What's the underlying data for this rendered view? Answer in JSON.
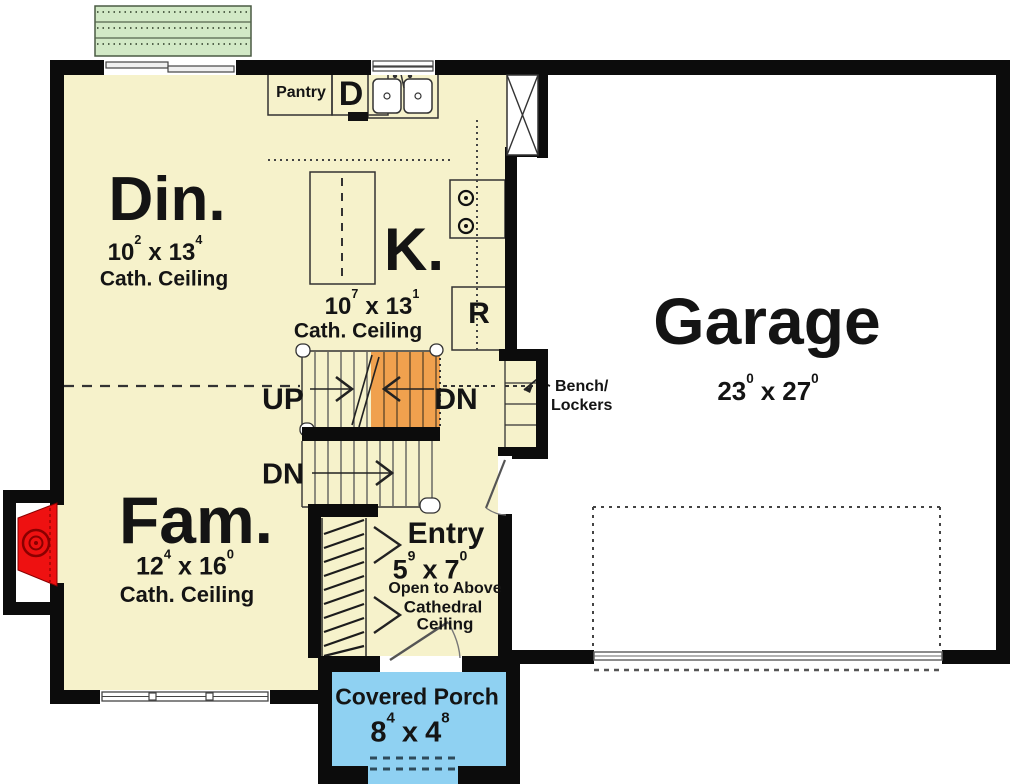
{
  "colors": {
    "floor": "#f6f2cb",
    "deck": "#d2e9c6",
    "porch": "#8fd1f2",
    "stair_highlight": "#f0a14e",
    "fireplace": "#ee1111",
    "wall": "#0c0c0c"
  },
  "labels": {
    "x_separator": "x",
    "pantry": "Pantry",
    "dishwasher": "D",
    "refrigerator": "R",
    "up": "UP",
    "down_upper": "DN",
    "down_lower": "DN",
    "bench_line1": "Bench/",
    "bench_line2": "Lockers"
  },
  "rooms": {
    "dining": {
      "name": "Din.",
      "w": "10",
      "w_sup": "2",
      "l": "13",
      "l_sup": "4",
      "ceiling": "Cath. Ceiling"
    },
    "kitchen": {
      "name": "K.",
      "w": "10",
      "w_sup": "7",
      "l": "13",
      "l_sup": "1",
      "ceiling": "Cath. Ceiling"
    },
    "family": {
      "name": "Fam.",
      "w": "12",
      "w_sup": "4",
      "l": "16",
      "l_sup": "0",
      "ceiling": "Cath. Ceiling"
    },
    "garage": {
      "name": "Garage",
      "w": "23",
      "w_sup": "0",
      "l": "27",
      "l_sup": "0"
    },
    "entry": {
      "name": "Entry",
      "w": "5",
      "w_sup": "9",
      "l": "7",
      "l_sup": "0",
      "note1": "Open to Above",
      "note2": "Cathedral",
      "note3": "Ceiling"
    },
    "porch": {
      "name": "Covered Porch",
      "w": "8",
      "w_sup": "4",
      "l": "4",
      "l_sup": "8"
    }
  }
}
